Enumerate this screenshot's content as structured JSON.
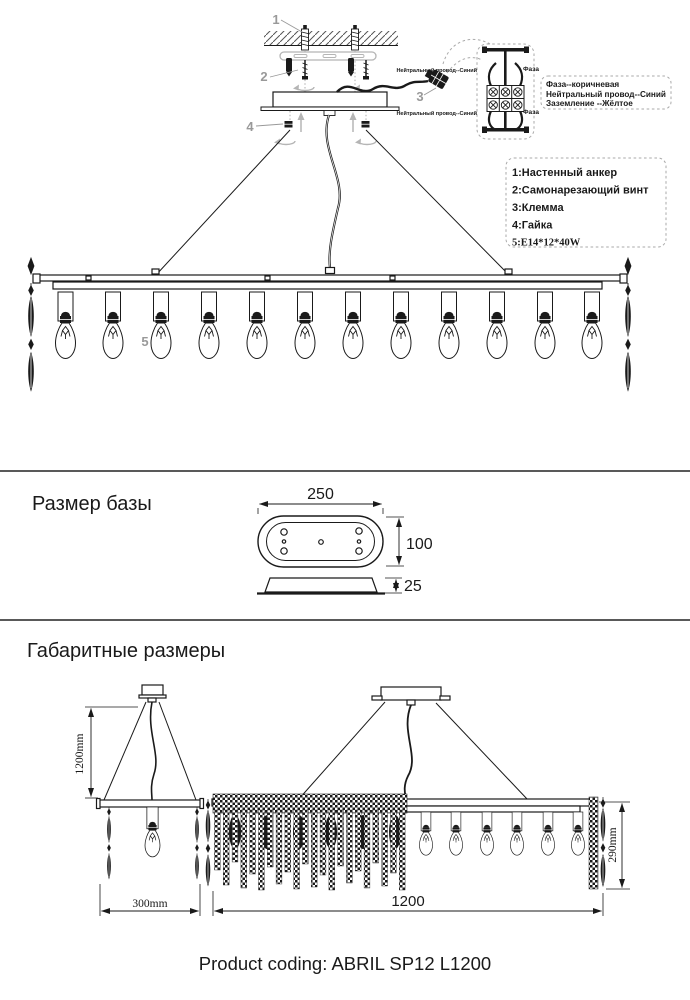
{
  "colors": {
    "ink": "#1a1a1a",
    "callout_gray": "#999999",
    "hardware_gray": "#b5b5b5",
    "background": "#ffffff"
  },
  "install": {
    "callouts": {
      "n1": "1",
      "n2": "2",
      "n3": "3",
      "n4": "4",
      "n5": "5"
    },
    "wiring": {
      "neutral_top": "Нейтральный провод--Синий",
      "phase_top": "Фаза",
      "neutral_bottom": "Нейтральный провод--Синий",
      "phase_bottom": "Фаза",
      "info_line1": "Фаза--коричневая",
      "info_line2": "Нейтральный провод--Синий",
      "info_line3": "Заземление --Жёлтое"
    },
    "legend": {
      "item1": "1:Настенный анкер",
      "item2": "2:Самонарезающий винт",
      "item3": "3:Клемма",
      "item4": "4:Гайка",
      "item5": "5:E14*12*40W"
    }
  },
  "base_size": {
    "title": "Размер базы",
    "width": "250",
    "height": "100",
    "thickness": "25"
  },
  "overall_size": {
    "title": "Габаритные размеры",
    "drop_height": "1200mm",
    "side_width": "300mm",
    "length": "1200",
    "fixture_height": "290mm"
  },
  "footer": {
    "product_coding": "Product coding: ABRIL SP12 L1200"
  }
}
